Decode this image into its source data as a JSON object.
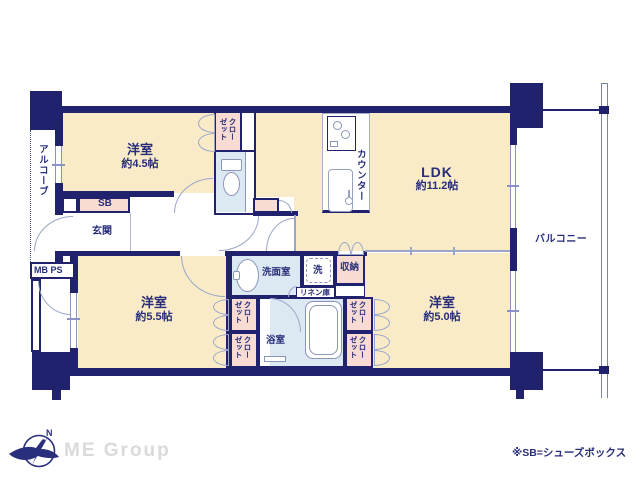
{
  "plan": {
    "room_45": {
      "name": "洋室",
      "size": "約4.5帖"
    },
    "ldk": {
      "name": "LDK",
      "size": "約11.2帖"
    },
    "room_55": {
      "name": "洋室",
      "size": "約5.5帖"
    },
    "room_50": {
      "name": "洋室",
      "size": "約5.0帖"
    },
    "labels": {
      "balcony": "バルコニー",
      "alcove": "アルコーブ",
      "entrance": "玄関",
      "shoe_box": "SB",
      "mb_ps": "MB PS",
      "counter": "カウンター",
      "washroom": "洗面室",
      "laundry": "洗",
      "storage": "収納",
      "linen": "リネン庫",
      "bathroom": "浴室",
      "closet": "クローゼット"
    }
  },
  "footer": {
    "note": "※SB=シューズボックス",
    "brand": "ME Group",
    "compass_north": "N"
  },
  "colors": {
    "wall": "#20226e",
    "room_floor": "#f9ebc8",
    "closet_pink": "#f8dbd3",
    "wet_blue": "#dce8f2",
    "door_line": "#9aa6c8",
    "label_text": "#272d7a"
  }
}
